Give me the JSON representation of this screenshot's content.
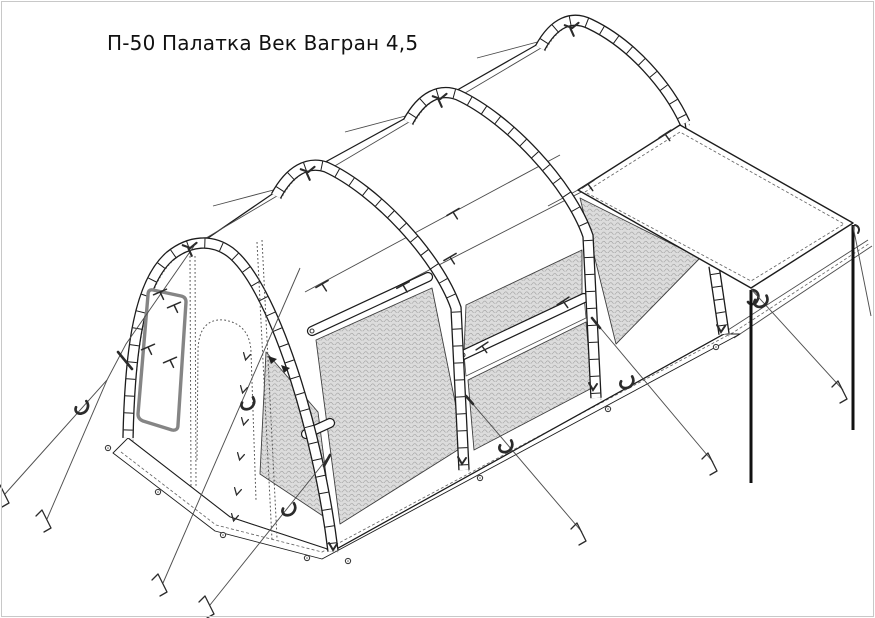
{
  "title": "П-50 Палатка Век Вагран 4,5",
  "canvas": {
    "width": 875,
    "height": 618
  },
  "colors": {
    "background": "#ffffff",
    "page_border": "#c8c8c8",
    "line": "#1c1c1c",
    "line_soft": "#4a4a4a",
    "stitch": "#8a8a8a",
    "mesh_fill": "#dcdcdc",
    "mesh_weave": "#9d9d9d",
    "hardware": "#2b2b2b",
    "window_frame": "#858585",
    "rope": "#4f4f4f"
  }
}
